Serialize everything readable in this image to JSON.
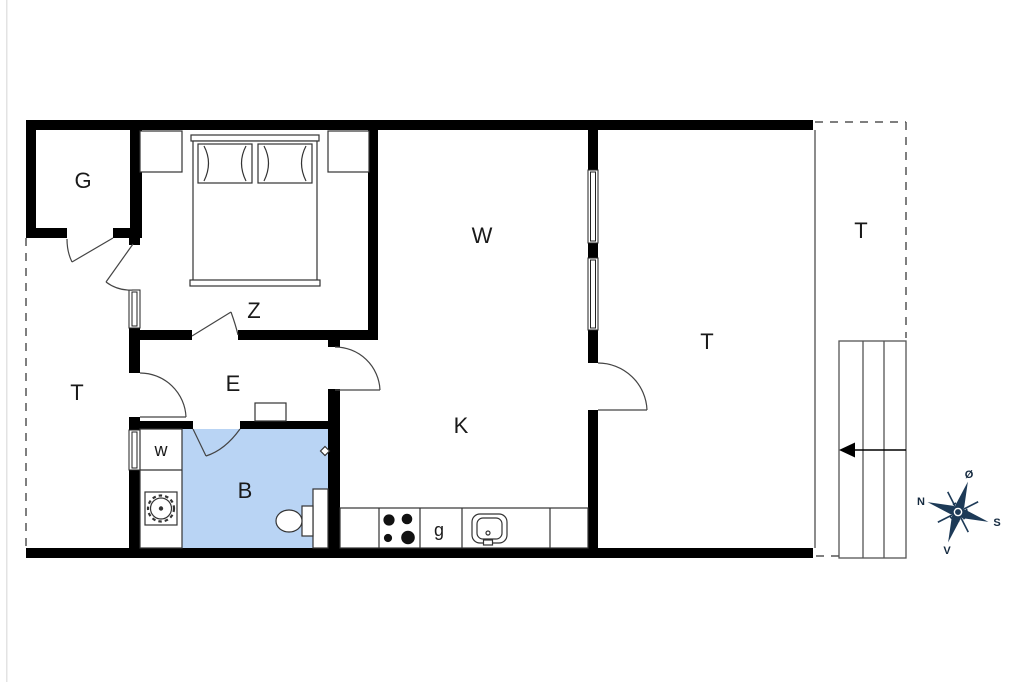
{
  "title": "floor-plan",
  "rooms": {
    "g": {
      "label": "G"
    },
    "z": {
      "label": "Z"
    },
    "w_living": {
      "label": "W"
    },
    "e": {
      "label": "E"
    },
    "t_left": {
      "label": "T"
    },
    "w_closet": {
      "label": "w"
    },
    "b": {
      "label": "B"
    },
    "k": {
      "label": "K"
    },
    "g_counter": {
      "label": "g"
    },
    "t_sunroom": {
      "label": "T"
    },
    "t_terrace": {
      "label": "T"
    }
  },
  "compass": {
    "north": "N",
    "south": "S",
    "east": "Ø",
    "west": "V"
  },
  "colors": {
    "bathroom_fill": "#b9d4f4",
    "compass_navy": "#1d3a57",
    "wall_black": "#000000"
  }
}
